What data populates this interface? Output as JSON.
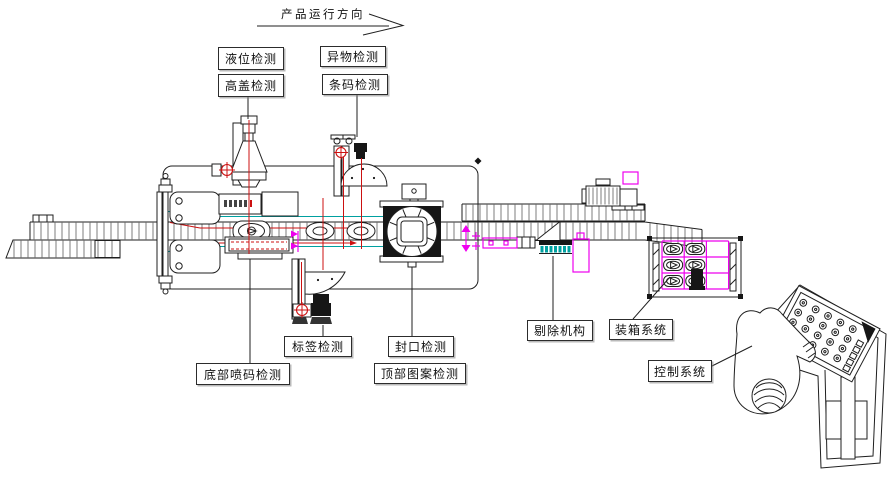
{
  "diagram": {
    "direction_label": "产品运行方向",
    "callouts": {
      "liquid_level": "液位检测",
      "high_cap": "高盖检测",
      "foreign_object": "异物检测",
      "barcode": "条码检测",
      "label_check": "标签检测",
      "bottom_code": "底部喷码检测",
      "seal": "封口检测",
      "top_pattern": "顶部图案检测",
      "reject": "剔除机构",
      "boxing": "装箱系统",
      "control": "控制系统"
    },
    "colors": {
      "line_black": "#1f1f1f",
      "crosshair_red": "#cc1111",
      "guide_cyan": "#00a0a0",
      "marker_magenta": "#ee00ee"
    }
  }
}
